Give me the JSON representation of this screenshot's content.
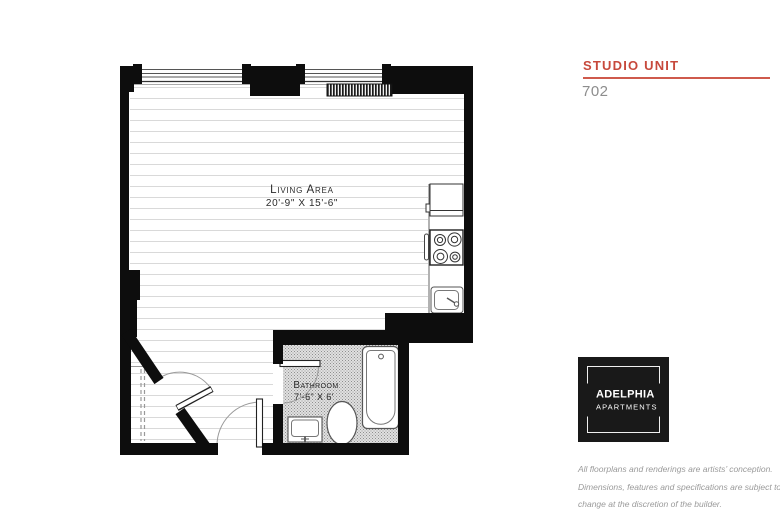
{
  "header": {
    "title": "STUDIO UNIT",
    "unit_number": "702",
    "accent_color": "#c7493c"
  },
  "floorplan": {
    "living_area": {
      "label": "Living Area",
      "dimensions": "20'-9\" X 15'-6\""
    },
    "bathroom": {
      "label": "Bathroom",
      "dimensions": "7'-6\" X 6'"
    }
  },
  "logo": {
    "name": "ADELPHIA",
    "subname": "APARTMENTS",
    "background_color": "#191919",
    "text_color": "#ffffff"
  },
  "disclaimer": {
    "line1": "All floorplans and renderings are artists’ conception.",
    "line2": "Dimensions, features and specifications are subject to",
    "line3": "change at the discretion of the builder."
  }
}
